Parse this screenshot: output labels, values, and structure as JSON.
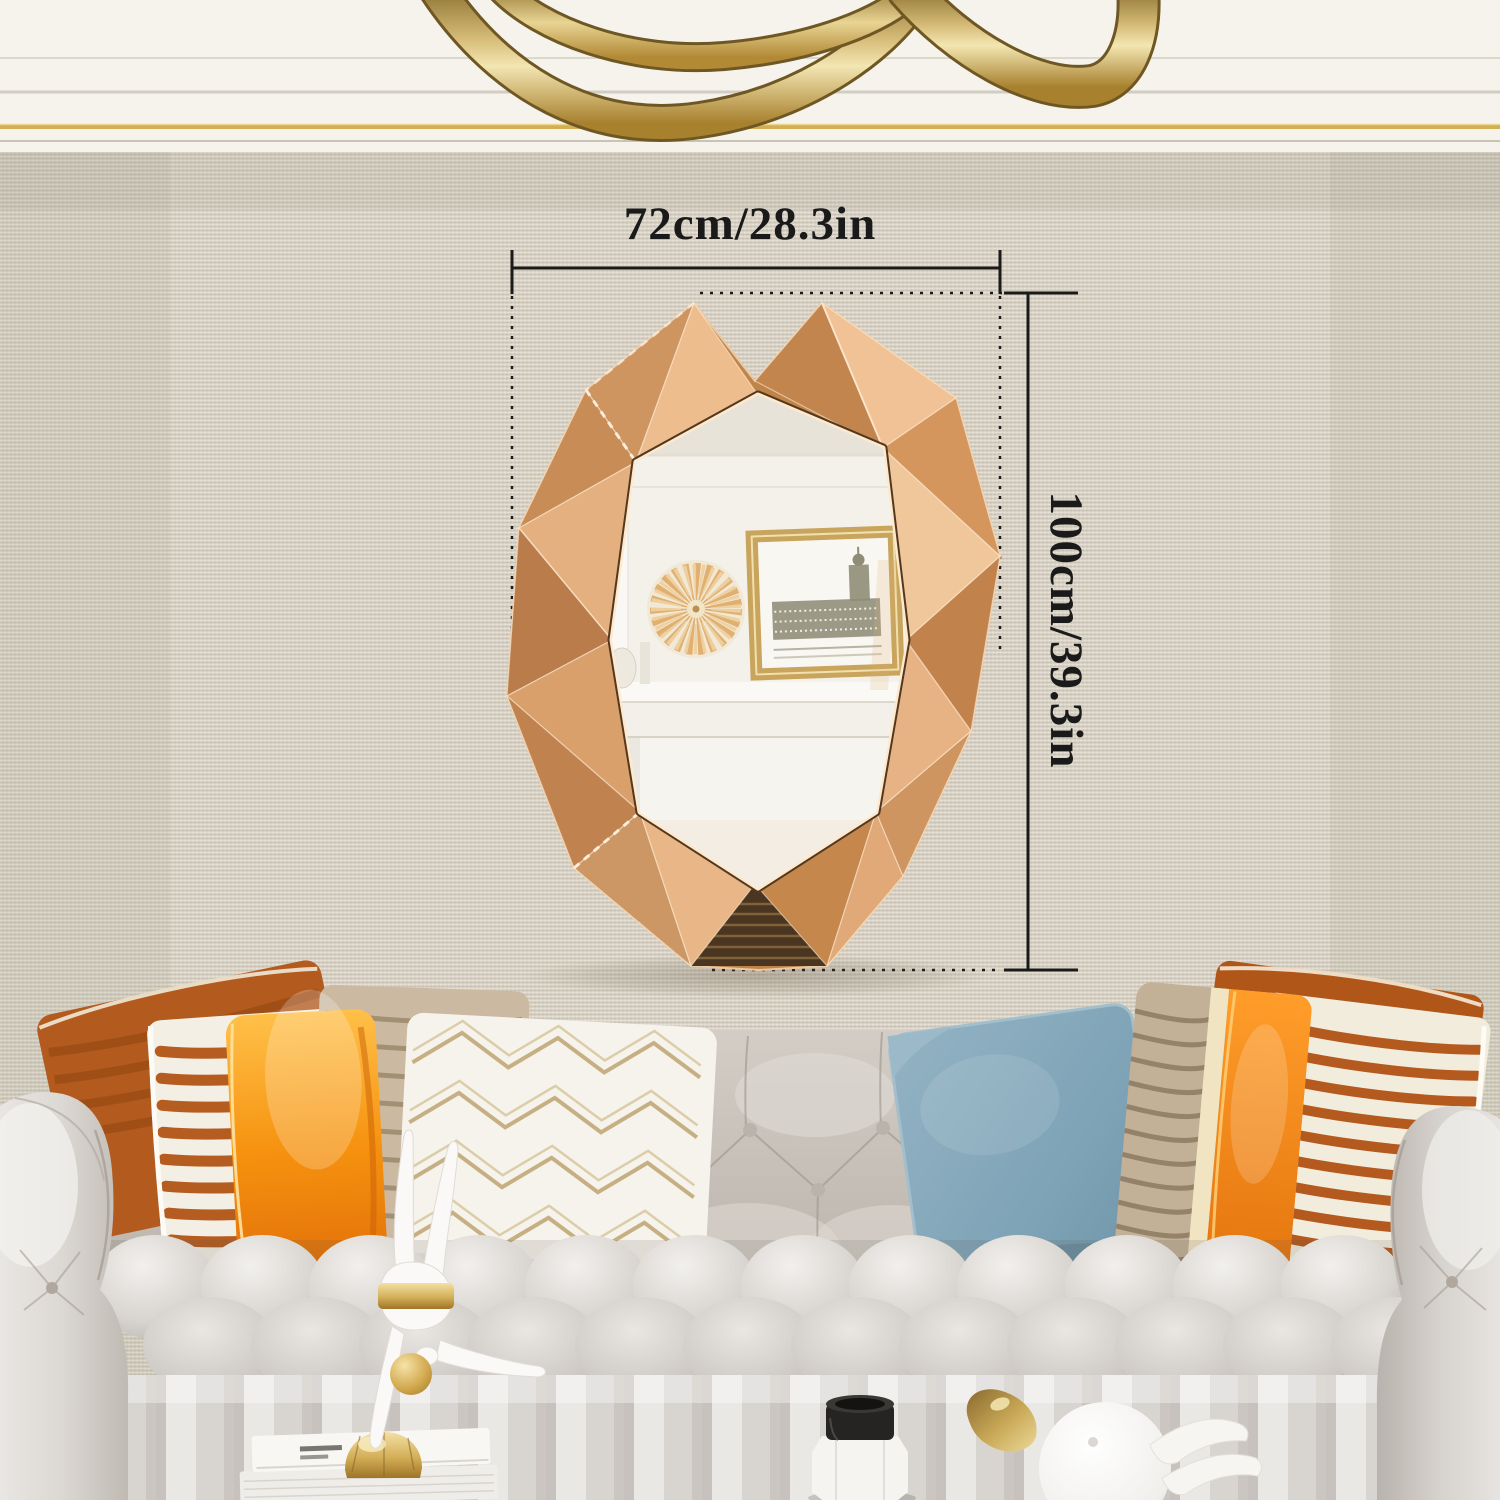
{
  "annotations": {
    "width_label": "72cm/28.3in",
    "height_label": "100cm/39.3in"
  },
  "colors": {
    "ink": "#1a1a1a",
    "wall": "#d9d3c5",
    "band": "#f6f3ec",
    "trim-gold": "#d2ae55",
    "rose": "#d89a64",
    "orange": "#f08c1c",
    "rust": "#b55c20",
    "blue": "#7ea3b6",
    "sofa": "#cfc9c2"
  }
}
